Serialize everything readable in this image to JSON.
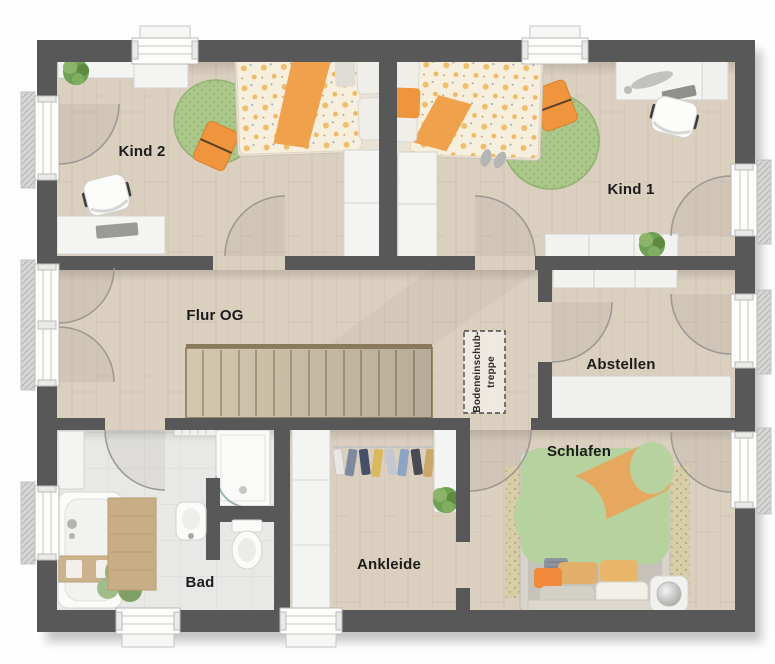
{
  "plan": {
    "rooms": {
      "kind2": {
        "label": "Kind 2"
      },
      "kind1": {
        "label": "Kind 1"
      },
      "flur": {
        "label": "Flur OG"
      },
      "abstellen": {
        "label": "Abstellen"
      },
      "schlafen": {
        "label": "Schlafen"
      },
      "ankleide": {
        "label": "Ankleide"
      },
      "bad": {
        "label": "Bad"
      }
    },
    "annotations": {
      "attic_hatch": {
        "line1": "Bodeneinschub-",
        "line2": "treppe"
      }
    },
    "colors": {
      "wall": "#585858",
      "wood_floor": "#dbcfbf",
      "tile_floor": "#e8e8e6",
      "rug_green": "#abc78a",
      "accent_orange": "#ef953e",
      "bed_green": "#b6d29e",
      "furniture_white": "#f4f4f2"
    }
  }
}
